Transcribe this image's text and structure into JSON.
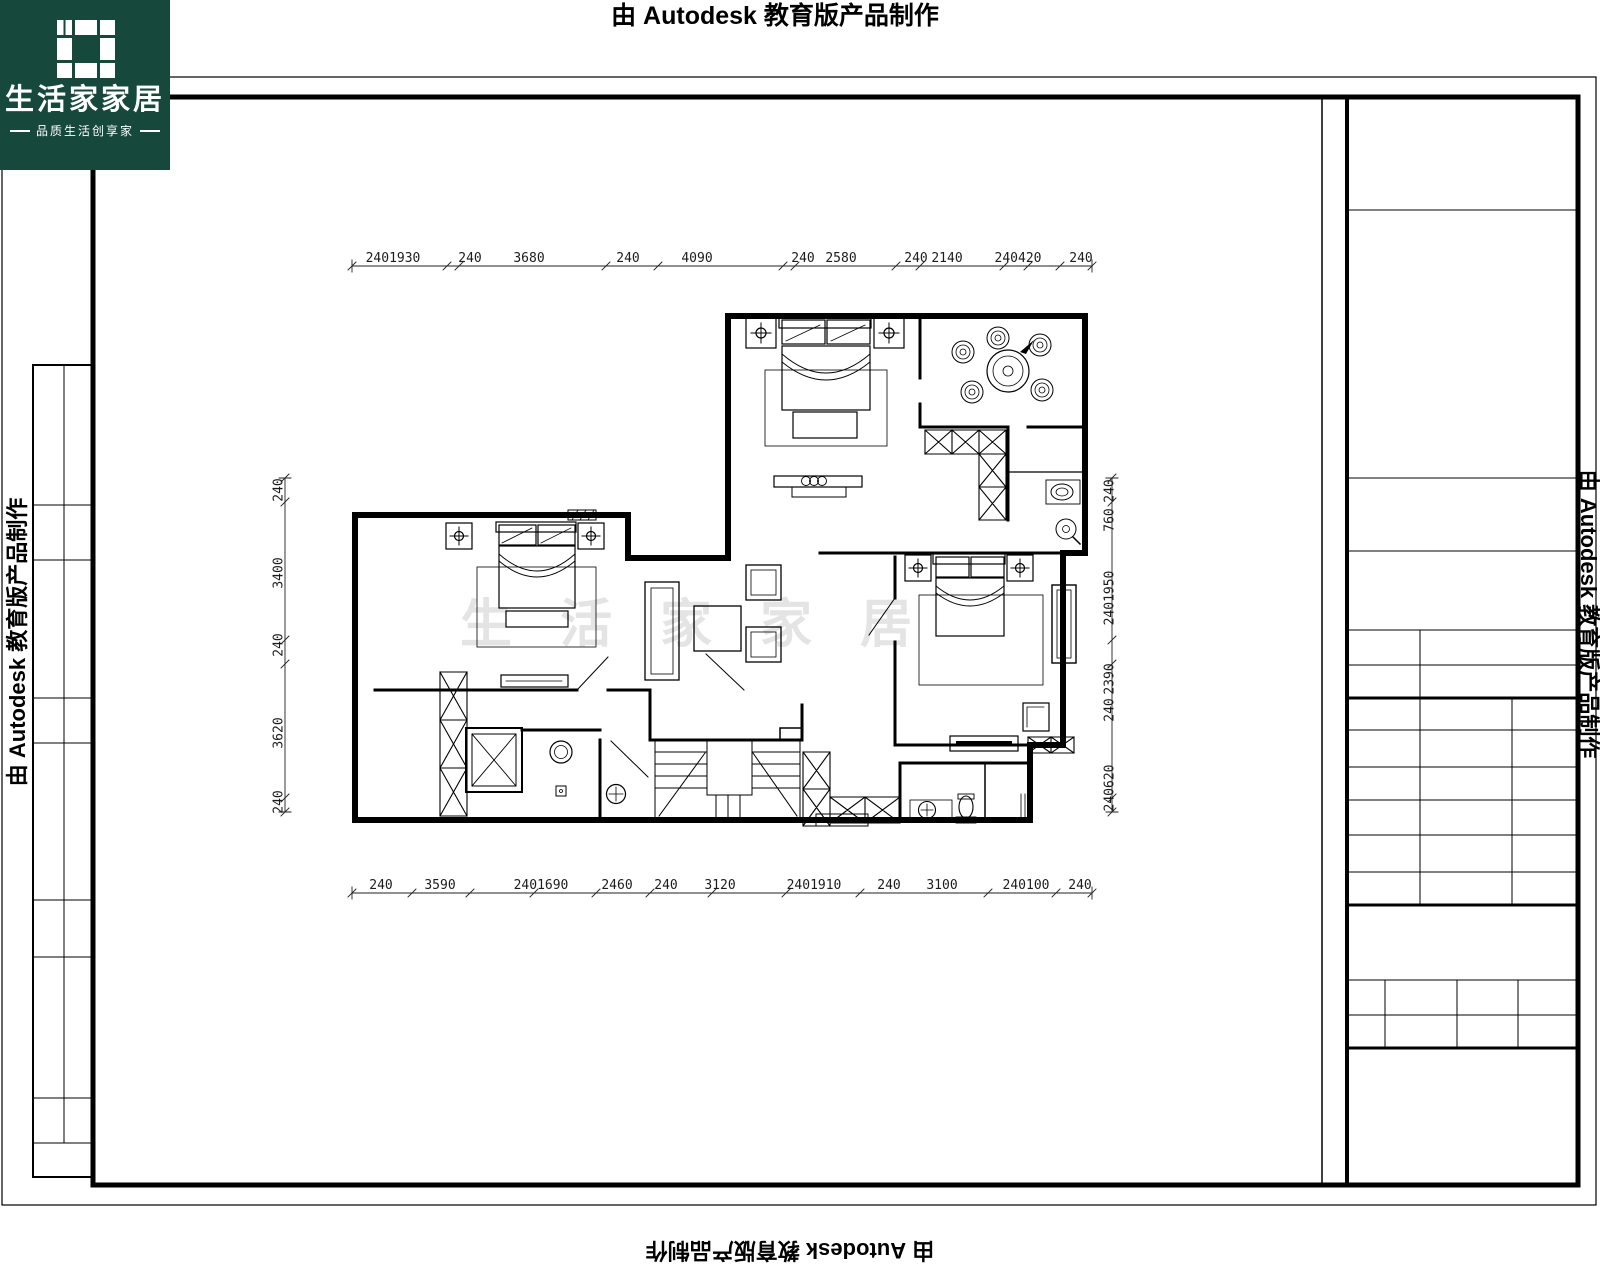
{
  "watermarks": {
    "autodesk": "由 Autodesk 教育版产品制作"
  },
  "logo": {
    "title": "生活家家居",
    "subtitle": "品质生活创享家"
  },
  "plan": {
    "center_watermark": "生活家家居"
  },
  "colors": {
    "logo_bg": "#16493B",
    "line": "#000000",
    "faint_watermark": "#E4E4E4"
  },
  "dims": {
    "top": [
      {
        "t": "2401930",
        "x": 393
      },
      {
        "t": "240",
        "x": 470
      },
      {
        "t": "3680",
        "x": 529
      },
      {
        "t": "240",
        "x": 628
      },
      {
        "t": "4090",
        "x": 697
      },
      {
        "t": "240",
        "x": 803
      },
      {
        "t": "2580",
        "x": 841
      },
      {
        "t": "240",
        "x": 916
      },
      {
        "t": "2140",
        "x": 947
      },
      {
        "t": "240420",
        "x": 1018
      },
      {
        "t": "240",
        "x": 1081
      }
    ],
    "bottom": [
      {
        "t": "240",
        "x": 381
      },
      {
        "t": "3590",
        "x": 440
      },
      {
        "t": "2401690",
        "x": 541
      },
      {
        "t": "2460",
        "x": 617
      },
      {
        "t": "240",
        "x": 666
      },
      {
        "t": "3120",
        "x": 720
      },
      {
        "t": "2401910",
        "x": 814
      },
      {
        "t": "240",
        "x": 889
      },
      {
        "t": "3100",
        "x": 942
      },
      {
        "t": "240100",
        "x": 1026
      },
      {
        "t": "240",
        "x": 1080
      }
    ],
    "left": [
      {
        "t": "240",
        "y": 490
      },
      {
        "t": "3400",
        "y": 573
      },
      {
        "t": "240",
        "y": 645
      },
      {
        "t": "3620",
        "y": 733
      },
      {
        "t": "240",
        "y": 802
      }
    ],
    "right": [
      {
        "t": "240",
        "y": 491
      },
      {
        "t": "760",
        "y": 520
      },
      {
        "t": "2401950",
        "y": 598
      },
      {
        "t": "2390",
        "y": 679
      },
      {
        "t": "240",
        "y": 710
      },
      {
        "t": "240620",
        "y": 788
      }
    ]
  }
}
